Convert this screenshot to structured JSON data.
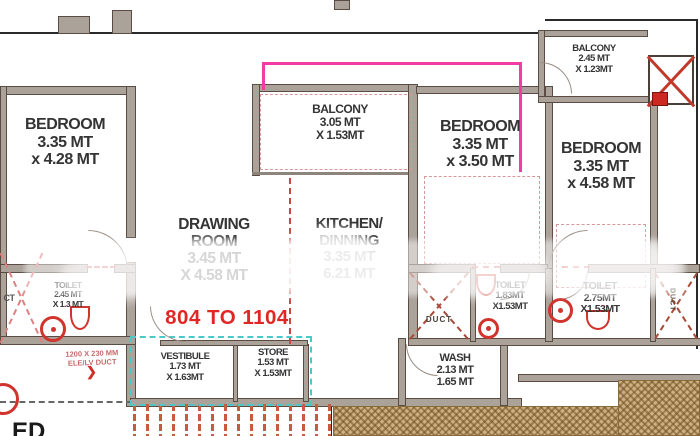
{
  "rooms": {
    "bedroom_left": "BEDROOM\n3.35 MT\nx 4.28 MT",
    "balcony_center": "BALCONY\n3.05 MT\nX 1.53MT",
    "balcony_top_right": "BALCONY\n2.45 MT\nX 1.23MT",
    "bedroom_center": "BEDROOM\n3.35 MT\nx 3.50 MT",
    "bedroom_right": "BEDROOM\n3.35 MT\nx 4.58 MT",
    "drawing_room": "DRAWING\nROOM\n3.45 MT\nX 4.58 MT",
    "kitchen_dining": "KITCHEN/\nDINNING\n3.35 MT\n6.21 MT",
    "toilet_left": "TOILET\n2.45 MT\nX 1.3 MT",
    "vestibule": "VESTIBULE\n1.73 MT\nX 1.63MT",
    "store": "STORE\n1.53 MT\nX 1.53MT",
    "wash": "WASH\n2.13 MT\n1.65 MT",
    "toilet_middle": "TOILET\n1.83MT\nX1.53MT",
    "toilet_right": "TOILET\n2.75MT\nX1.53MT",
    "duct_middle": "DUCT",
    "duct_right": "DUCT",
    "duct_left_partial": "CT"
  },
  "annotations": {
    "unit_range": "804 TO 1104",
    "ele_lv_duct": "1200 X 230 MM\nELE/LV DUCT",
    "arrow": "❯",
    "partial_text": "ED"
  },
  "colors": {
    "wall_fill": "#aba29a",
    "unit_range_red": "#e12726",
    "annotation_red": "#c66a6a",
    "magenta_line": "#f23ba4",
    "cyan_dashed": "#49c9c9",
    "hatch_brown": "#cdb183",
    "fixture_red": "#d0342c"
  }
}
